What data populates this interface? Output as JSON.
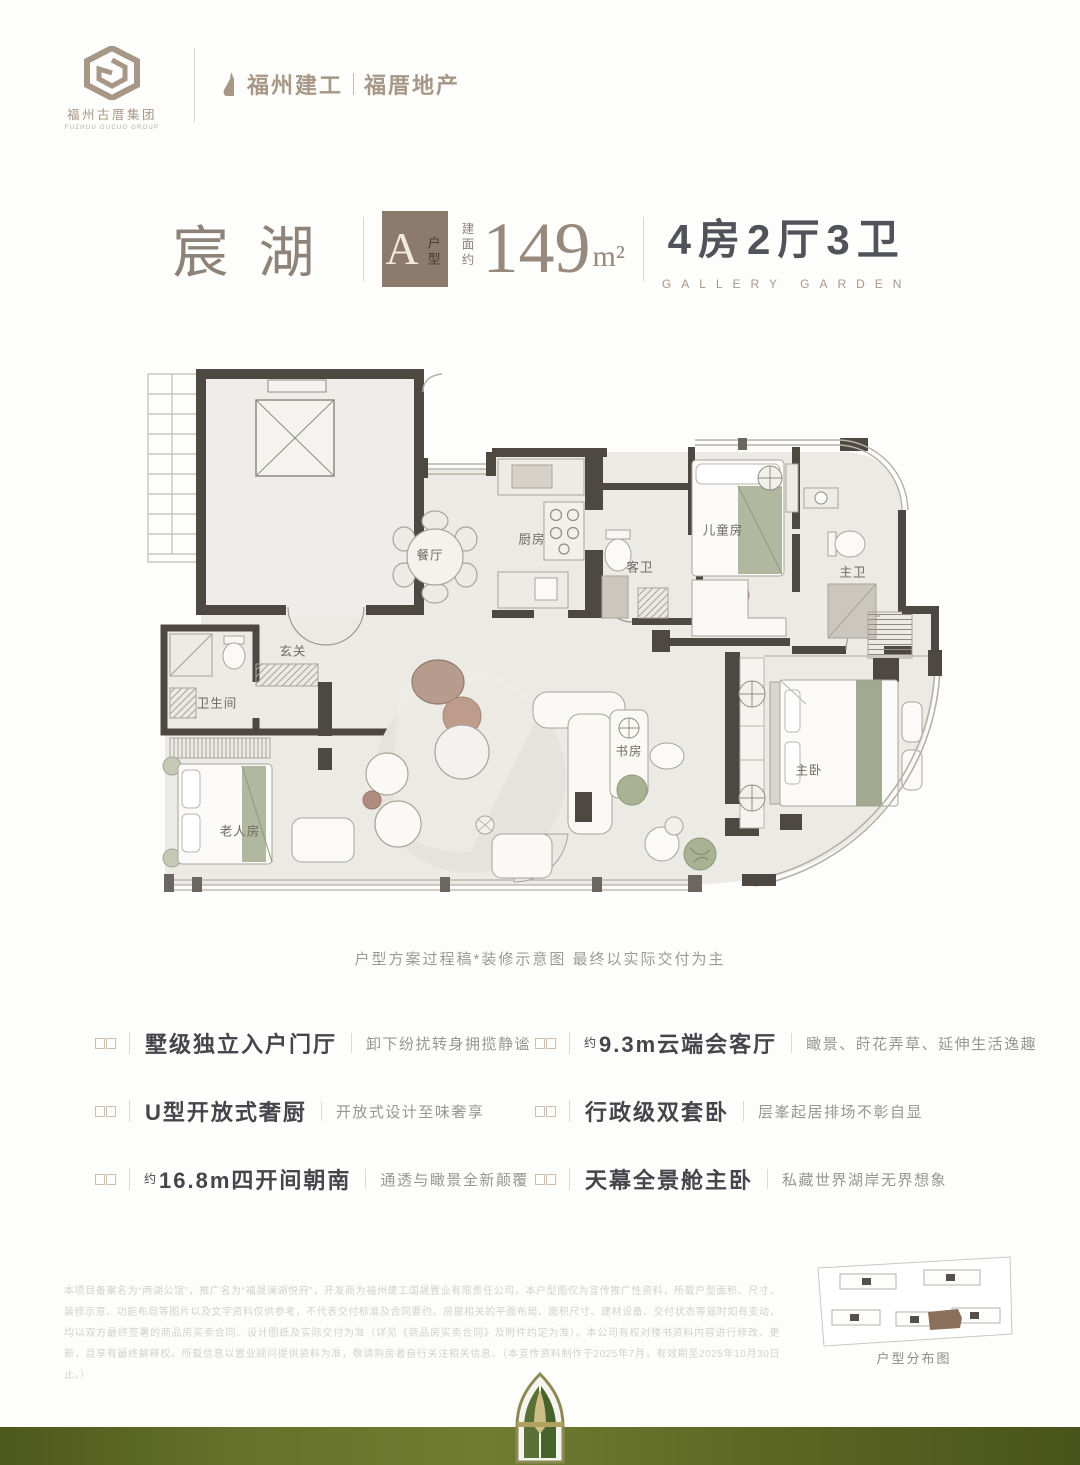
{
  "brand": {
    "group_name": "福州古厝集团",
    "group_name_en": "FUZHOU GUCUO GROUP",
    "logo_letter": "G",
    "partner_left": "福州建工",
    "partner_right": "福厝地产"
  },
  "header": {
    "project_name": "宸湖",
    "unit_badge": "A",
    "unit_badge_suffix": "户型",
    "area_prefix": "建面约",
    "area_value": "149",
    "area_unit": "m²",
    "layout": "4房2厅3卫",
    "layout_en": "GALLERY GARDEN"
  },
  "floorplan": {
    "rooms": [
      {
        "label": "餐厅"
      },
      {
        "label": "厨房"
      },
      {
        "label": "客卫"
      },
      {
        "label": "儿童房"
      },
      {
        "label": "主卫"
      },
      {
        "label": "玄关"
      },
      {
        "label": "卫生间"
      },
      {
        "label": "老人房"
      },
      {
        "label": "书房"
      },
      {
        "label": "主卧"
      }
    ],
    "caption": "户型方案过程稿*装修示意图  最终以实际交付为主"
  },
  "features": {
    "left": [
      {
        "prefix": "",
        "title": "墅级独立入户门厅",
        "desc": "卸下纷扰转身拥揽静谧"
      },
      {
        "prefix": "",
        "title": "U型开放式奢厨",
        "desc": "开放式设计至味奢享"
      },
      {
        "prefix": "约",
        "title": "16.8m四开间朝南",
        "desc": "通透与瞰景全新颠覆"
      }
    ],
    "right": [
      {
        "prefix": "约",
        "title": "9.3m云端会客厅",
        "desc": "瞰景、莳花弄草、延伸生活逸趣"
      },
      {
        "prefix": "",
        "title": "行政级双套卧",
        "desc": "层峯起居排场不彰自显"
      },
      {
        "prefix": "",
        "title": "天幕全景舱主卧",
        "desc": "私藏世界湖岸无界想象"
      }
    ]
  },
  "footer": {
    "disclaimer": "本项目备案名为“两湖公馆”，推广名为“福晟澜湖悦府”，开发商为福州建工国晟置业有限责任公司。本户型图仅为宣传推广性资料，所载户型面积、尺寸、装修示意、功能布局等图片以及文字资料仅供参考，不代表交付标准及合同要约。房屋相关的平面布局、面积尺寸、建材设备、交付状态等届时如有变动，均以双方最终签署的商品房买卖合同、设计图纸及实际交付为准（详见《商品房买卖合同》及附件约定为准）。本公司有权对楼书资料内容进行修改、更新，且享有最终解释权。所载信息以置业顾问提供资料为准，敬请购房者自行关注相关信息。（本宣传资料制作于2025年7月，有效期至2025年10月30日止。）",
    "sitemap_caption": "户型分布图"
  },
  "colors": {
    "brand_taupe": "#A79786",
    "badge_brown": "#8C7B6D",
    "title_dark": "#51525A",
    "wall_dark": "#4D4842",
    "floor": "#ECEAE5",
    "accent_green": "#A9B293",
    "band_olive": "#5B6624"
  }
}
